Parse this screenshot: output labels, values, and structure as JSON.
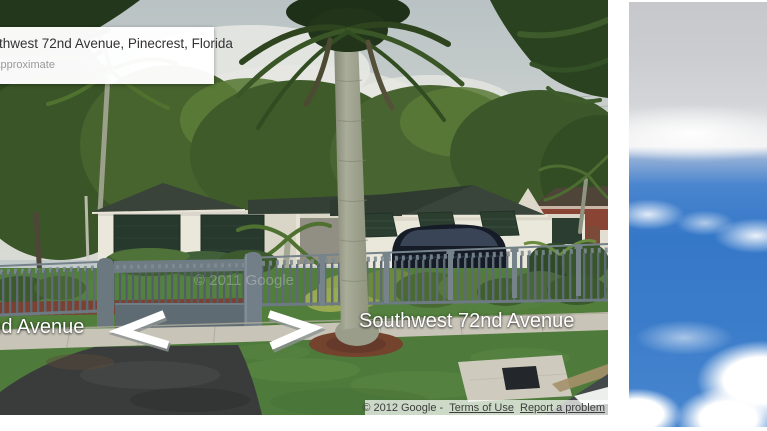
{
  "viewer": {
    "address_card": {
      "title": "Southwest 72nd Avenue, Pinecrest, Florida",
      "subtitle": "Address is approximate"
    },
    "street_labels": {
      "left": "Southwest 72nd Avenue",
      "right": "Southwest 72nd Avenue"
    },
    "navigation_arrows": {
      "left_icon": "chevron-left",
      "right_icon": "chevron-right"
    },
    "watermark": "© 2011 Google",
    "attribution": {
      "copyright": "© 2012 Google -",
      "terms_link": "Terms of Use",
      "report_link": "Report a problem"
    }
  },
  "scene": {
    "colors": {
      "sky_haze": "#c3cbca",
      "cloud_white": "#e9eae4",
      "tree_green": "#42602c",
      "roof_dark": "#343f36",
      "wall_cream": "#eae7db",
      "shutter_green": "#27382c",
      "fence_gray": "#75828a",
      "gate_gray": "#5f6b72",
      "lawn_green": "#527e3c",
      "mulch_brown": "#7b4233",
      "sidewalk_concrete": "#c8c5b8",
      "driveway_asphalt": "#393c3b",
      "road_asphalt": "#43484a",
      "road_stripe": "#edefec",
      "palm_trunk": "#9da18c",
      "sky_blue": "#3678c8",
      "suv_dark": "#151c27",
      "brick_red": "#8a4434"
    }
  }
}
